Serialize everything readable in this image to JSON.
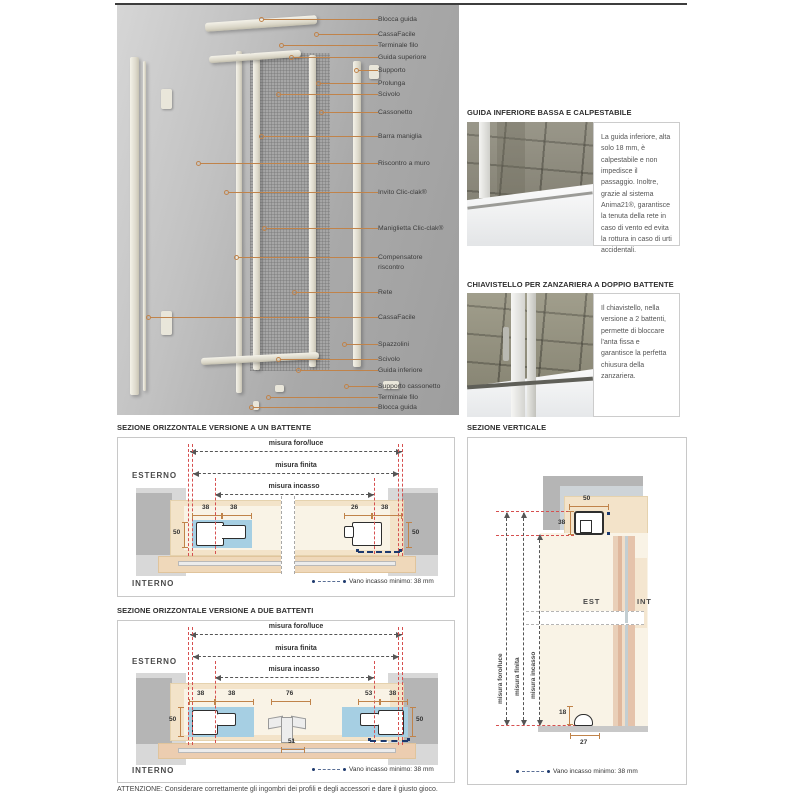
{
  "page": {
    "footer": "ATTENZIONE: Considerare correttamente gli ingombri dei profili e degli accessori e dare il giusto gioco."
  },
  "colors": {
    "leader_orange": "#c0834a",
    "red_reference": "#d65050",
    "navy_marker": "#1e3a6e",
    "blue_highlight": "#a6cfe3",
    "casing_beige": "#f3e3c9",
    "wall_grey": "#b5b5b5"
  },
  "exploded": {
    "labels": [
      {
        "text": "Blocca guida",
        "y": 10,
        "line": 115
      },
      {
        "text": "CassaFacile",
        "y": 25,
        "line": 60
      },
      {
        "text": "Terminale filo",
        "y": 36,
        "line": 95
      },
      {
        "text": "Guida superiore",
        "y": 48,
        "line": 85
      },
      {
        "text": "Supporto",
        "y": 61,
        "line": 20
      },
      {
        "text": "Prolunga",
        "y": 74,
        "line": 58
      },
      {
        "text": "Scivolo",
        "y": 85,
        "line": 98
      },
      {
        "text": "Cassonetto",
        "y": 103,
        "line": 55
      },
      {
        "text": "Barra maniglia",
        "y": 127,
        "line": 115
      },
      {
        "text": "Riscontro a muro",
        "y": 154,
        "line": 178
      },
      {
        "text": "Invito Clic-clak®",
        "y": 183,
        "line": 150
      },
      {
        "text": "Maniglietta Clic-clak®",
        "y": 219,
        "line": 112
      },
      {
        "text": "Compensatore riscontro",
        "y": 248,
        "line": 140,
        "w": 62
      },
      {
        "text": "Rete",
        "y": 283,
        "line": 82
      },
      {
        "text": "CassaFacile",
        "y": 308,
        "line": 228
      },
      {
        "text": "Spazzolini",
        "y": 335,
        "line": 32
      },
      {
        "text": "Scivolo",
        "y": 350,
        "line": 98
      },
      {
        "text": "Guida inferiore",
        "y": 361,
        "line": 78
      },
      {
        "text": "Supporto cassonetto",
        "y": 377,
        "line": 30
      },
      {
        "text": "Terminale filo",
        "y": 388,
        "line": 108
      },
      {
        "text": "Blocca guida",
        "y": 398,
        "line": 125
      }
    ]
  },
  "info_cards": [
    {
      "title": "GUIDA INFERIORE BASSA E CALPESTABILE",
      "body": "La guida inferiore, alta solo 18 mm, è calpestabile e non impedisce il passaggio. Inoltre, grazie al sistema Anima21®, garantisce la tenuta della rete in caso di vento ed evita la rottura in caso di urti accidentali."
    },
    {
      "title": "CHIAVISTELLO PER ZANZARIERA A DOPPIO BATTENTE",
      "body": "Il chiavistello, nella versione a 2 battenti, permette di bloccare l'anta fissa e garantisce la perfetta chiusura della zanzariera."
    }
  ],
  "sections": {
    "one": {
      "title": "SEZIONE ORIZZONTALE VERSIONE A UN BATTENTE",
      "esterno": "ESTERNO",
      "interno": "INTERNO",
      "dim_labels": [
        "misura foro/luce",
        "misura finita",
        "misura incasso"
      ],
      "dims": {
        "la": "38",
        "lb": "38",
        "lh": "50",
        "ra": "26",
        "rb": "38",
        "rh": "50"
      },
      "legend": "Vano incasso minimo: 38 mm"
    },
    "two": {
      "title": "SEZIONE ORIZZONTALE VERSIONE A DUE BATTENTI",
      "esterno": "ESTERNO",
      "interno": "INTERNO",
      "dim_labels": [
        "misura foro/luce",
        "misura finita",
        "misura incasso"
      ],
      "dims": {
        "la": "38",
        "lb": "38",
        "lh": "50",
        "c_top": "76",
        "c_bot": "51",
        "ra": "53",
        "rb": "38",
        "rh": "50"
      },
      "legend": "Vano incasso minimo: 38 mm"
    },
    "vertical": {
      "title": "SEZIONE VERTICALE",
      "est": "EST",
      "int": "INT",
      "dim_labels": [
        "misura foro/luce",
        "misura finita",
        "misura incasso"
      ],
      "dims": {
        "top_w": "50",
        "top_h": "38",
        "bot_h": "18",
        "bot_w": "27"
      },
      "legend": "Vano incasso minimo: 38 mm"
    }
  }
}
